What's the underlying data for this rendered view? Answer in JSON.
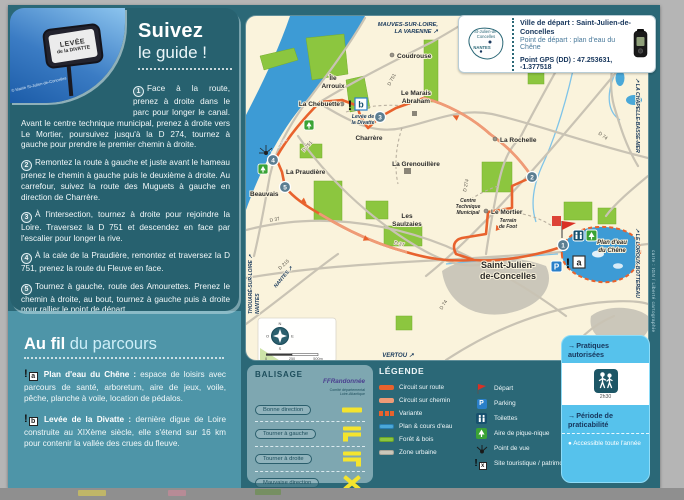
{
  "photo": {
    "sign_line1": "LEVÉE",
    "sign_line2": "de la DIVATTE",
    "credit": "© Mairie St-Julien-de-Concelles"
  },
  "guide": {
    "title_bold": "Suivez",
    "title_light": "le guide !",
    "steps": [
      {
        "num": "1",
        "text": "Face à la route, prenez à droite dans le parc pour longer le canal. Avant le centre technique municipal, prenez à droite vers Le Mortier, poursuivez jusqu'à la D 274, tournez à gauche pour prendre le premier chemin à droite."
      },
      {
        "num": "2",
        "text": "Remontez la route à gauche et juste avant le hameau prenez le chemin à gauche puis le deuxième à droite. Au carrefour, suivez la route des Muguets à gauche en direction de Charrère."
      },
      {
        "num": "3",
        "text": "À l'intersection, tournez à droite pour rejoindre la Loire. Traversez la D 751 et descendez en face par l'escalier pour longer la rive."
      },
      {
        "num": "4",
        "text": "À la cale de la Praudière, remontez et traversez la D 751, prenez la route du Fleuve en face."
      },
      {
        "num": "5",
        "text": "Tournez à gauche, route des Amourettes. Prenez le chemin à droite, au bout, tournez à gauche puis à droite pour rallier le point de départ."
      }
    ]
  },
  "parcours": {
    "title_bold": "Au fil",
    "title_light": "du parcours",
    "items": [
      {
        "letter": "a",
        "lead": "Plan d'eau du Chêne :",
        "text": "espace de loisirs avec parcours de santé, arboretum, aire de jeux, voile, pêche, planche à voile, location de pédalos."
      },
      {
        "letter": "b",
        "lead": "Levée de la Divatte :",
        "text": "dernière digue de Loire construite au XIXème siècle, elle s'étend sur 16 km pour contenir la vallée des crues du fleuve."
      }
    ]
  },
  "infobox": {
    "line1": "Ville de départ : Saint-Julien-de-Concelles",
    "line2": "Point de départ : plan d'eau du Chêne",
    "line3": "Point GPS (DD) : 47.253631, -1.377518",
    "sketch_town1": "St-Julien-de-",
    "sketch_town2": "Concelles",
    "sketch_city": "NANTES"
  },
  "balisage": {
    "title": "BALISAGE",
    "logo": "FFRandonnée",
    "logo_sub1": "Comité départemental",
    "logo_sub2": "Loire-Atlantique",
    "items": [
      "Bonne direction",
      "Tourner à gauche",
      "Tourner à droite",
      "Mauvaise direction"
    ]
  },
  "legende": {
    "title": "LÉGENDE",
    "left": [
      "Circuit sur route",
      "Circuit sur chemin",
      "Variante",
      "Plan & cours d'eau",
      "Forêt & bois",
      "Zone urbaine"
    ],
    "right": [
      "Départ",
      "Parking",
      "Toilettes",
      "Aire de pique-nique",
      "Point de vue",
      "Site touristique / patrimoine"
    ],
    "parking_letter": "P"
  },
  "pratiques": {
    "arrow": "→",
    "title": "Pratiques autorisées",
    "duration": "2h30",
    "period_title": "Période de praticabilité",
    "bullet": "●",
    "period_item": "Accessible toute l'année"
  },
  "map": {
    "labels": {
      "mauves1": "MAUVES-SUR-LOIRE,",
      "mauves2": "LA VARENNE ↗",
      "coudrouse": "Coudrouse",
      "ile1": "Île",
      "ile2": "Arrouix",
      "chebuette": "La Chebuette",
      "marais1": "Le Marais",
      "marais2": "Abraham",
      "charrere": "Charrère",
      "grenouillere": "La Grenouillère",
      "rochelle": "La Rochelle",
      "praudiere": "La Praudière",
      "beauvais": "Beauvais",
      "saulzaies1": "Les",
      "saulzaies2": "Saulzaies",
      "mortier": "Le Mortier",
      "centre1": "Centre",
      "centre2": "Technique",
      "centre3": "Municipal",
      "terrain1": "Terrain",
      "terrain2": "de Foot",
      "stjulien1": "Saint-Julien-",
      "stjulien2": "de-Concelles",
      "lake1": "Plan d'eau",
      "lake2": "du Chêne",
      "loire": "La Loire",
      "levee1": "Levée de",
      "levee2": "la Divatte",
      "vertou": "VERTOU ↗",
      "chapelle": "↗ LA CHAPELLE-BASSE-MER",
      "loroux": "↗ LE LOROUX-BOTTEREAU",
      "thouare": "THOUARÉ-SUR-LOIRE ↗",
      "nantes_v": "NANTES",
      "nantes_d": "NANTES ↗"
    },
    "roads": {
      "r751a": "D 751",
      "r751b": "D 751",
      "r74a": "D 74",
      "r74b": "D 74",
      "r274": "D 274",
      "r37a": "D 37",
      "r37b": "D 37",
      "r215": "D 215"
    },
    "markers": {
      "m1": "1",
      "m2": "2",
      "m3": "3",
      "m4": "4",
      "m5": "5"
    },
    "sites": {
      "bang": "!",
      "a": "a",
      "b": "b",
      "x": "x"
    },
    "parking": "P",
    "compass": {
      "n": "N",
      "e": "E",
      "s": "S",
      "o": "O"
    },
    "scale": {
      "s0": "0",
      "s1": "250",
      "s2": "500m"
    },
    "credit": "carte : IGN / Liberté cartographie"
  }
}
